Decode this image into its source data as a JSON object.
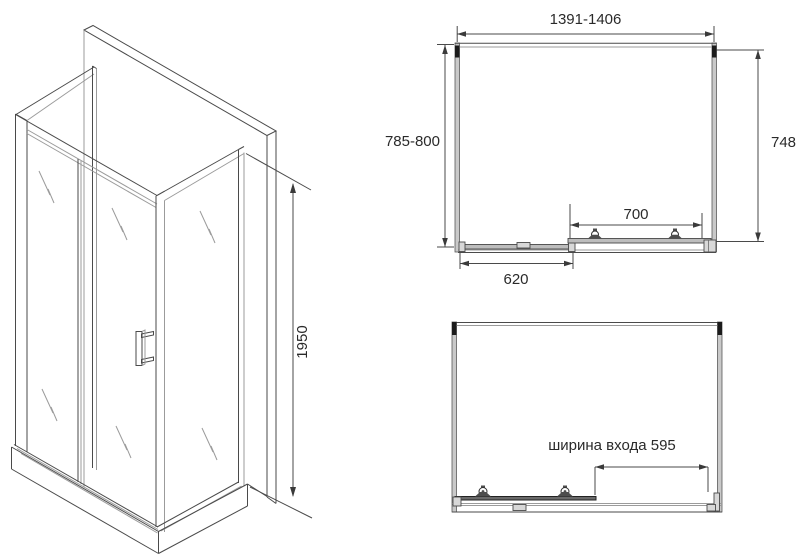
{
  "colors": {
    "background": "#ffffff",
    "line": "#4a4a4a",
    "line_light": "#9b9b9b",
    "text": "#2a2a2a",
    "profile_fill": "#c9c9c9",
    "dark_detail": "#1b1b1b"
  },
  "iso_view": {
    "height": "1950"
  },
  "plan_top": {
    "width_range": "1391-1406",
    "depth_range": "785-800",
    "depth_inner": "748",
    "door_width": "700",
    "fixed_panel_width": "620"
  },
  "plan_bottom": {
    "entrance_width_label": "ширина входа 595"
  }
}
